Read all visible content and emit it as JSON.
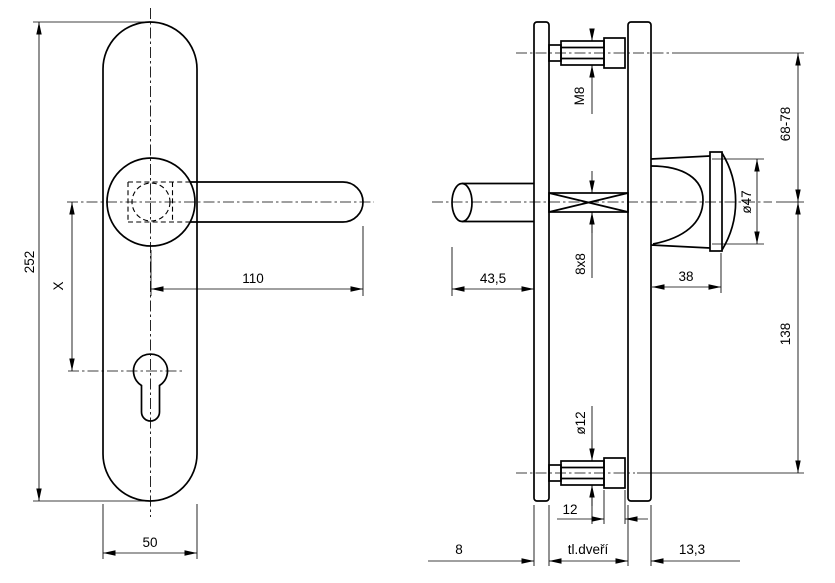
{
  "colors": {
    "line": "#000000",
    "background": "#ffffff"
  },
  "dims": {
    "plate_height": "252",
    "x_offset": "X",
    "lever_length": "110",
    "plate_width": "50",
    "lever_projection": "43,5",
    "thread": "M8",
    "spindle": "8x8",
    "knob_diameter": "ø47",
    "knob_length": "38",
    "top_bolt_to_axis": "68-78",
    "axis_to_bottom_bolt": "138",
    "bottom_bolt_diameter": "ø12",
    "sleeve_length": "12",
    "inner_plate_thickness": "8",
    "door_thickness": "tl.dveří",
    "outer_plate_thickness": "13,3"
  }
}
